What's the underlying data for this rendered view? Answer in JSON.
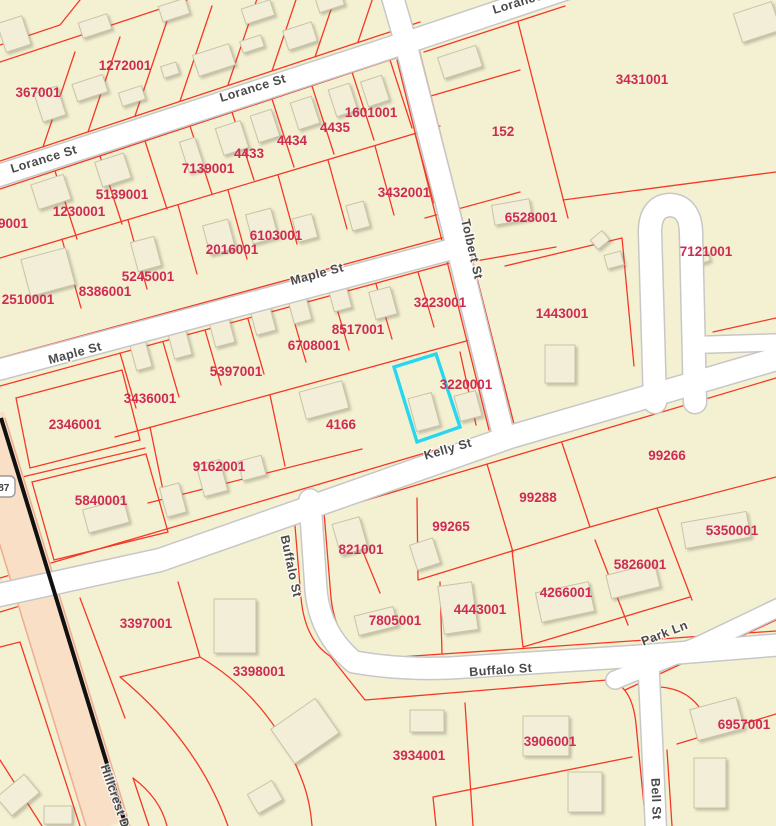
{
  "map": {
    "background_color": "#f4f1d2",
    "parcel_line_color": "#f53826",
    "parcel_label_color": "#cf2b52",
    "road_fill_color": "#ffffff",
    "road_casing_color": "#c7c7c7",
    "highway_fill_color": "#f8dfc6",
    "highway_edge_color": "#eeae90",
    "highway_centerline_color": "#111111",
    "building_fill_color": "#f2eed8",
    "building_outline_color": "#c8c4aa",
    "highlight_color": "#29d6f0",
    "route_shield": {
      "label": "287",
      "x": 1,
      "y": 487
    },
    "parcel_labels": [
      {
        "id": "367001",
        "x": 38,
        "y": 92
      },
      {
        "id": "1272001",
        "x": 125,
        "y": 65
      },
      {
        "id": "9001",
        "x": 13,
        "y": 223
      },
      {
        "id": "1230001",
        "x": 79,
        "y": 211
      },
      {
        "id": "5139001",
        "x": 122,
        "y": 194
      },
      {
        "id": "7139001",
        "x": 208,
        "y": 168
      },
      {
        "id": "4433",
        "x": 249,
        "y": 153
      },
      {
        "id": "4434",
        "x": 292,
        "y": 140
      },
      {
        "id": "4435",
        "x": 335,
        "y": 127
      },
      {
        "id": "1601001",
        "x": 371,
        "y": 112
      },
      {
        "id": "3432001",
        "x": 404,
        "y": 192
      },
      {
        "id": "6103001",
        "x": 276,
        "y": 235
      },
      {
        "id": "2016001",
        "x": 232,
        "y": 249
      },
      {
        "id": "5245001",
        "x": 148,
        "y": 276
      },
      {
        "id": "8386001",
        "x": 105,
        "y": 291
      },
      {
        "id": "2510001",
        "x": 28,
        "y": 299
      },
      {
        "id": "152",
        "x": 503,
        "y": 131
      },
      {
        "id": "3431001",
        "x": 642,
        "y": 79
      },
      {
        "id": "6528001",
        "x": 531,
        "y": 217
      },
      {
        "id": "7121001",
        "x": 706,
        "y": 251
      },
      {
        "id": "1443001",
        "x": 562,
        "y": 313
      },
      {
        "id": "3223001",
        "x": 440,
        "y": 302
      },
      {
        "id": "8517001",
        "x": 358,
        "y": 329
      },
      {
        "id": "6708001",
        "x": 314,
        "y": 345
      },
      {
        "id": "5397001",
        "x": 236,
        "y": 371
      },
      {
        "id": "3436001",
        "x": 150,
        "y": 398
      },
      {
        "id": "2346001",
        "x": 75,
        "y": 424
      },
      {
        "id": "3220001",
        "x": 466,
        "y": 384
      },
      {
        "id": "4166",
        "x": 341,
        "y": 424
      },
      {
        "id": "9162001",
        "x": 219,
        "y": 466
      },
      {
        "id": "5840001",
        "x": 101,
        "y": 500
      },
      {
        "id": "99266",
        "x": 667,
        "y": 455
      },
      {
        "id": "99288",
        "x": 538,
        "y": 497
      },
      {
        "id": "99265",
        "x": 451,
        "y": 526
      },
      {
        "id": "5350001",
        "x": 732,
        "y": 530
      },
      {
        "id": "821001",
        "x": 361,
        "y": 549
      },
      {
        "id": "5826001",
        "x": 640,
        "y": 564
      },
      {
        "id": "4266001",
        "x": 566,
        "y": 592
      },
      {
        "id": "4443001",
        "x": 480,
        "y": 609
      },
      {
        "id": "7805001",
        "x": 395,
        "y": 620
      },
      {
        "id": "3397001",
        "x": 146,
        "y": 623
      },
      {
        "id": "3398001",
        "x": 259,
        "y": 671
      },
      {
        "id": "3934001",
        "x": 419,
        "y": 755
      },
      {
        "id": "3906001",
        "x": 550,
        "y": 741
      },
      {
        "id": "6957001",
        "x": 744,
        "y": 724
      }
    ],
    "street_labels": [
      {
        "name": "Lorance St",
        "x": 45,
        "y": 163,
        "rotation": -17
      },
      {
        "name": "Lorance St",
        "x": 254,
        "y": 92,
        "rotation": -17
      },
      {
        "name": "Lorance St",
        "x": 527,
        "y": 4,
        "rotation": -17
      },
      {
        "name": "Maple St",
        "x": 76,
        "y": 357,
        "rotation": -15
      },
      {
        "name": "Maple St",
        "x": 318,
        "y": 278,
        "rotation": -15
      },
      {
        "name": "Tolbert St",
        "x": 468,
        "y": 250,
        "rotation": 77
      },
      {
        "name": "Kelly St",
        "x": 449,
        "y": 453,
        "rotation": -16
      },
      {
        "name": "Buffalo St",
        "x": 287,
        "y": 567,
        "rotation": 78
      },
      {
        "name": "Buffalo St",
        "x": 501,
        "y": 674,
        "rotation": -4
      },
      {
        "name": "Park Ln",
        "x": 666,
        "y": 637,
        "rotation": -21
      },
      {
        "name": "Bell St",
        "x": 652,
        "y": 799,
        "rotation": 88
      },
      {
        "name": "Hillcrest Dr",
        "x": 112,
        "y": 800,
        "rotation": 71
      }
    ]
  }
}
